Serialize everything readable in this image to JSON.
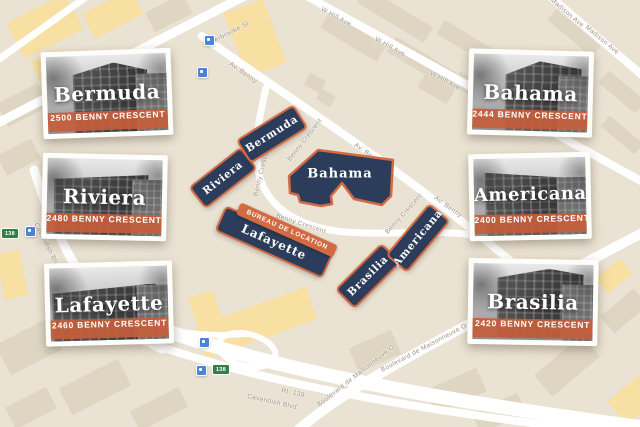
{
  "cards": [
    {
      "name": "Bermuda",
      "address": "2500 BENNY CRESCENT"
    },
    {
      "name": "Riviera",
      "address": "2480 BENNY CRESCENT"
    },
    {
      "name": "Lafayette",
      "address": "2460 BENNY CRESCENT"
    },
    {
      "name": "Bahama",
      "address": "2444 BENNY CRESCENT"
    },
    {
      "name": "Americana",
      "address": "2400 BENNY CRESCENT"
    },
    {
      "name": "Brasilia",
      "address": "2420 BENNY CRESCENT"
    }
  ],
  "map": {
    "office_banner": "BUREAU DE LOCATION",
    "buildings": [
      {
        "id": "riviera",
        "label": "Riviera"
      },
      {
        "id": "bermuda",
        "label": "Bermuda"
      },
      {
        "id": "bahama",
        "label": "Bahama"
      },
      {
        "id": "lafayette",
        "label": "Lafayette"
      },
      {
        "id": "brasilia",
        "label": "Brasilia"
      },
      {
        "id": "americana",
        "label": "Americana"
      }
    ],
    "streets": {
      "sherbrooke": "Sherbrooke St",
      "av_benny": "Av. Benny",
      "benny_crescent": "Benny Crescent",
      "w_hill": "W Hill Ave",
      "madison": "Madison Ave",
      "cavendish": "Cavendish Blvd",
      "rt138": "Rt. 138",
      "maisonneuve": "Boulevard de Maisonneuve O"
    },
    "route_shield": "138"
  },
  "colors": {
    "map_background": "#eae2d2",
    "block_beige": "#ded6c3",
    "block_yellow": "#f8dfa2",
    "building_navy": "#2c3d5b",
    "building_border_orange": "#d26a42",
    "address_banner": "#c45e3c",
    "road_white": "#ffffff",
    "transit_blue": "#4c83d9",
    "shield_green": "#33804a"
  }
}
